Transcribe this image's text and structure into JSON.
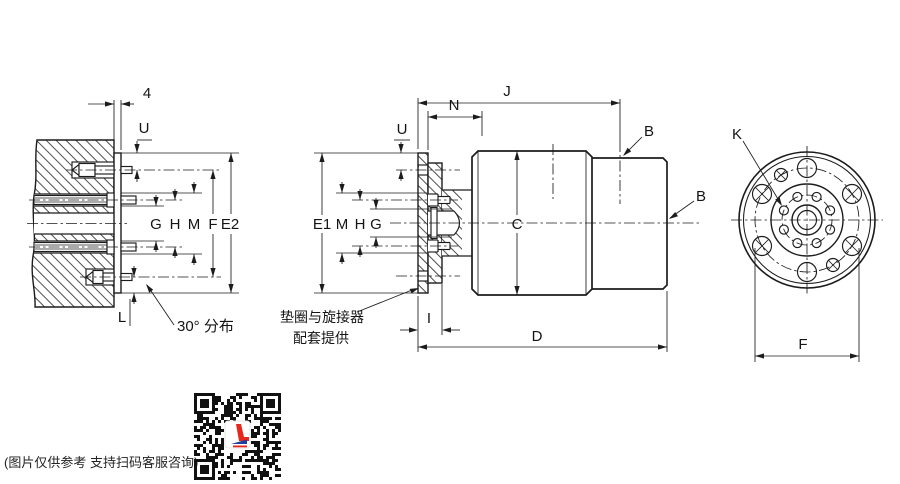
{
  "drawing": {
    "left_view": {
      "plate_thickness": "4",
      "u": "U",
      "g": "G",
      "h": "H",
      "m": "M",
      "f": "F",
      "e2": "E2",
      "l": "L",
      "angle_note": "30° 分布"
    },
    "front_view": {
      "j": "J",
      "n": "N",
      "u": "U",
      "b_top": "B",
      "b_end": "B",
      "e1": "E1",
      "m": "M",
      "h": "H",
      "g": "G",
      "c": "C",
      "i": "I",
      "d": "D",
      "note_line1": "垫圈与旋接器",
      "note_line2": "配套提供"
    },
    "end_view": {
      "k": "K",
      "f": "F"
    }
  },
  "footer": {
    "disclaimer": "(图片仅供参考 支持扫码客服咨询)"
  },
  "colors": {
    "line": "#1c1c1c",
    "hatch": "#3a3a3a",
    "qr_logo_red": "#e8271c",
    "qr_logo_blue": "#1e3f9e"
  }
}
